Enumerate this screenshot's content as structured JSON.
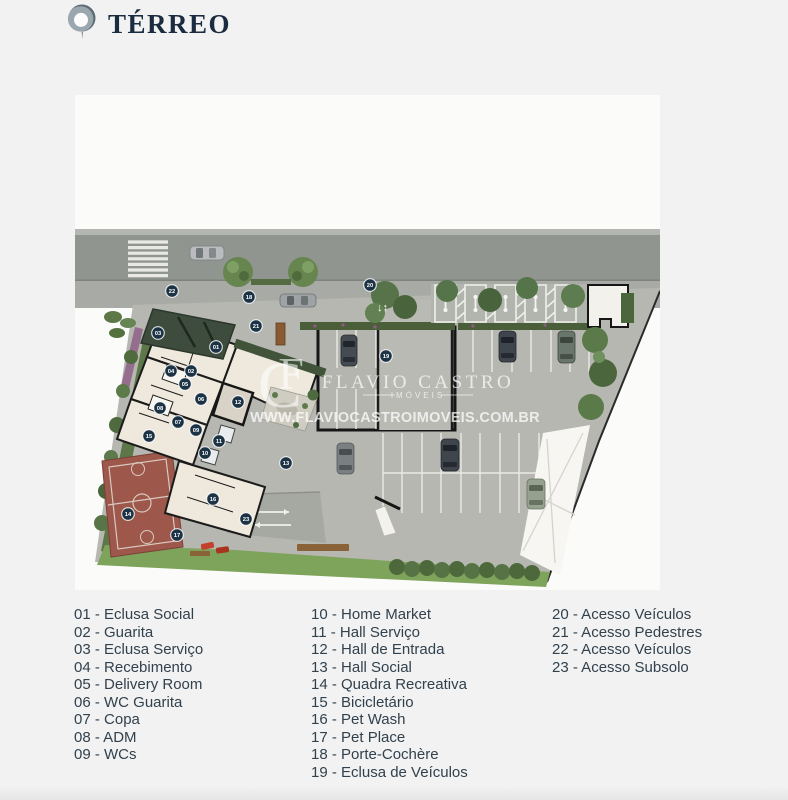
{
  "header": {
    "title": "TÉRREO",
    "logo": "brand-pin-logo"
  },
  "watermark": {
    "monogram_c": "C",
    "monogram_f": "F",
    "brand": "FLAVIO CASTRO",
    "brand_sub": "IMÓVEIS",
    "url": "WWW.FLAVIOCASTROIMOVEIS.COM.BR"
  },
  "plan": {
    "two_way_arrow": "↓↑",
    "badges": [
      {
        "n": "01",
        "x": 141,
        "y": 252
      },
      {
        "n": "02",
        "x": 116,
        "y": 276
      },
      {
        "n": "03",
        "x": 83,
        "y": 238
      },
      {
        "n": "04",
        "x": 96,
        "y": 276
      },
      {
        "n": "05",
        "x": 110,
        "y": 289
      },
      {
        "n": "06",
        "x": 126,
        "y": 304
      },
      {
        "n": "07",
        "x": 103,
        "y": 327
      },
      {
        "n": "08",
        "x": 85,
        "y": 313
      },
      {
        "n": "09",
        "x": 121,
        "y": 335
      },
      {
        "n": "10",
        "x": 130,
        "y": 358
      },
      {
        "n": "11",
        "x": 144,
        "y": 346
      },
      {
        "n": "12",
        "x": 163,
        "y": 307
      },
      {
        "n": "13",
        "x": 211,
        "y": 368
      },
      {
        "n": "14",
        "x": 53,
        "y": 419
      },
      {
        "n": "15",
        "x": 74,
        "y": 341
      },
      {
        "n": "16",
        "x": 138,
        "y": 404
      },
      {
        "n": "17",
        "x": 102,
        "y": 440
      },
      {
        "n": "18",
        "x": 174,
        "y": 202
      },
      {
        "n": "19",
        "x": 311,
        "y": 261
      },
      {
        "n": "20",
        "x": 295,
        "y": 190
      },
      {
        "n": "21",
        "x": 181,
        "y": 231
      },
      {
        "n": "22",
        "x": 97,
        "y": 196
      },
      {
        "n": "23",
        "x": 171,
        "y": 424
      }
    ]
  },
  "legend": {
    "columns": [
      {
        "items": [
          "01 - Eclusa Social",
          "02 - Guarita",
          "03 - Eclusa Serviço",
          "04 - Recebimento",
          "05 - Delivery Room",
          "06 - WC Guarita",
          "07 - Copa",
          "08 - ADM",
          "09 - WCs"
        ]
      },
      {
        "items": [
          "10 - Home Market",
          "11 - Hall Serviço",
          "12 - Hall de Entrada",
          "13 - Hall Social",
          "14 - Quadra Recreativa",
          "15 - Bicicletário",
          "16 - Pet Wash",
          "17 - Pet Place",
          "18 - Porte-Cochère",
          "19 - Eclusa de Veículos"
        ]
      },
      {
        "items": [
          "20 - Acesso Veículos",
          "21 - Acesso Pedestres",
          "22 - Acesso Veículos",
          "23 - Acesso Subsolo"
        ]
      }
    ]
  },
  "colors": {
    "badge": "#1c3345",
    "title": "#1b2c40",
    "legend_text": "#32414e",
    "road": "#90958f",
    "sidewalk": "#a8aba5",
    "lot": "#b6b7b1",
    "building": "#efe9dd",
    "canopy": "#3e4c3e",
    "court": "#9d574b",
    "lawn": "#7ea35a",
    "hedge": "#4b5e3a",
    "watermark": "#ffffff"
  }
}
